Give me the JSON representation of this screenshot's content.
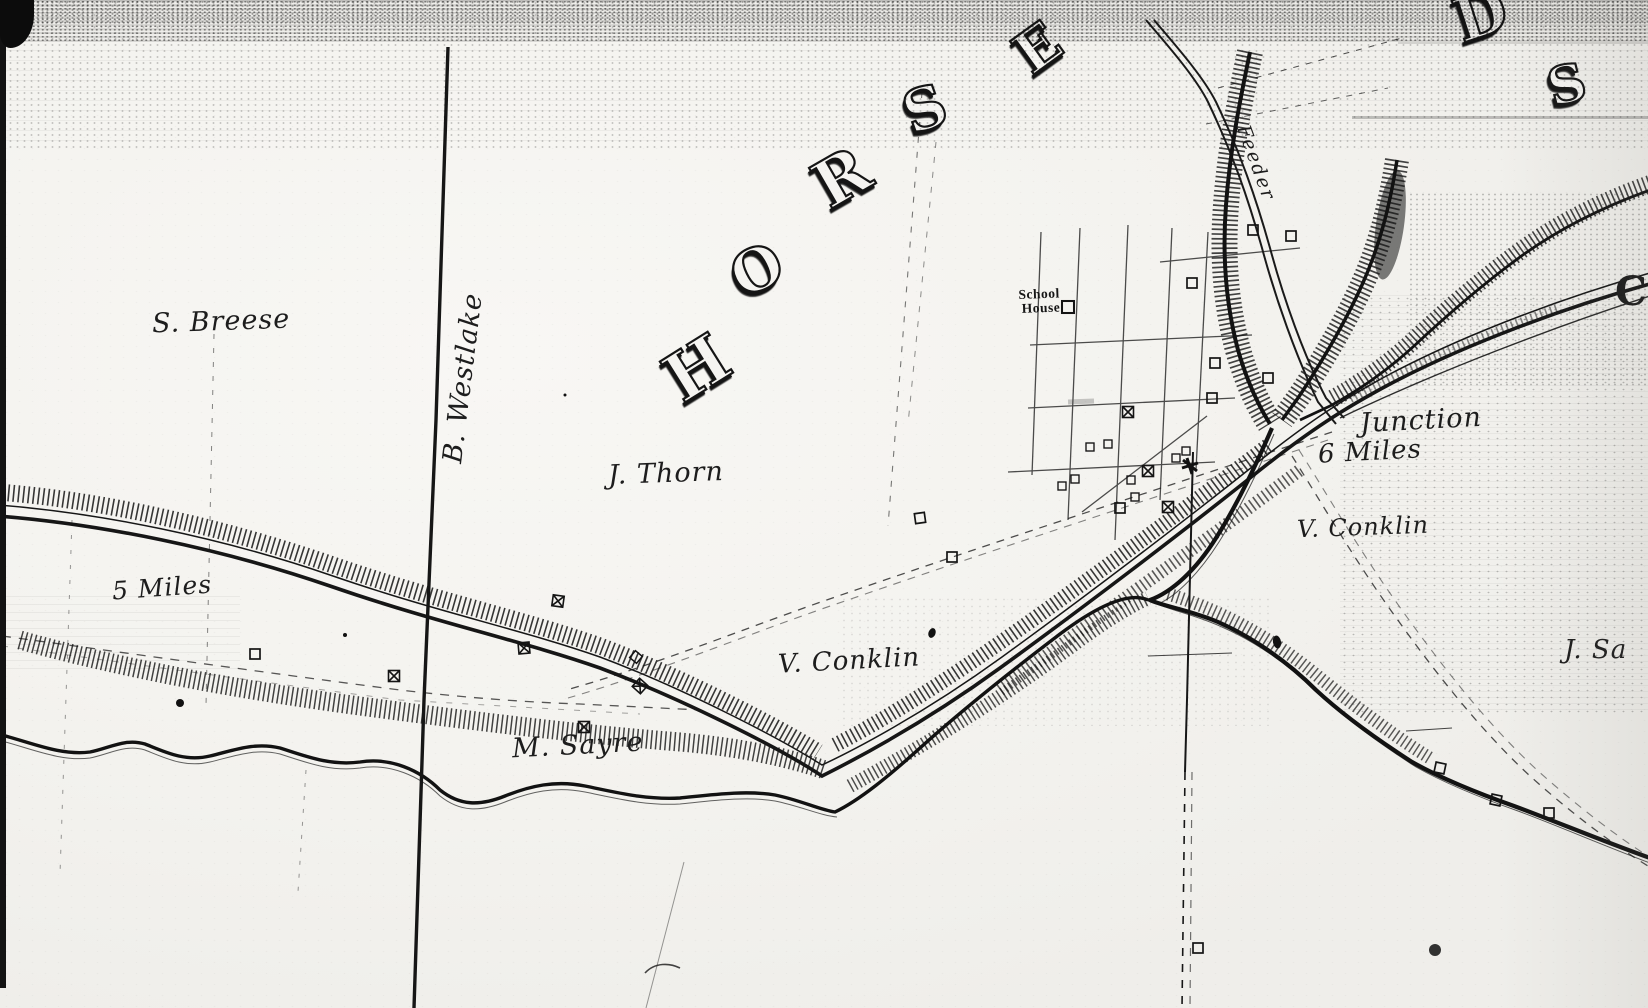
{
  "map": {
    "description": "Scanned 19th-century survey map of Horseheads village area with Chemung Canal, feeder, creeks, roads and landowner names",
    "colors": {
      "paper": "#f4f3f0",
      "ink": "#1b1b1b"
    },
    "title_letters": [
      "H",
      "O",
      "R",
      "S",
      "E",
      "D",
      "S"
    ],
    "edge_letter": "C",
    "labels": {
      "s_breese": "S. Breese",
      "b_westlake": "B. Westlake",
      "j_thorn": "J. Thorn",
      "five_miles": "5 Miles",
      "m_sayre": "M. Sayre",
      "v_conklin_west": "V. Conklin",
      "v_conklin_east": "V. Conklin",
      "junction": "Junction",
      "six_miles": "6 Miles",
      "j_sa": "J. Sa",
      "feeder": "Feeder",
      "school_line1": "School",
      "school_line2": "House"
    }
  }
}
